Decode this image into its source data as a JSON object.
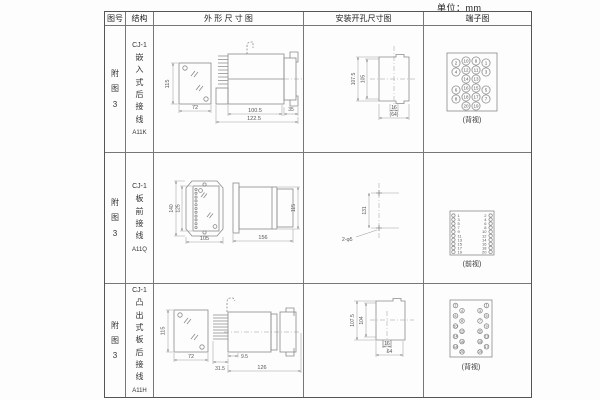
{
  "unit_label": "单位：mm",
  "headers": {
    "fig_no": "图号",
    "structure": "结构",
    "outline": "外 形 尺 寸 图",
    "mounting": "安装开孔尺寸图",
    "terminal": "端子图"
  },
  "rows": [
    {
      "fig_no": "附图3",
      "model": "CJ-1",
      "structure": "嵌入式后接线",
      "code": "A11K",
      "outline": {
        "front_h": "115",
        "front_w": "72",
        "body_len": "100.5",
        "total_len": "122.5",
        "flange": "35"
      },
      "mounting": {
        "outer_h": "107.5",
        "inner_h": "105",
        "slot_w": "16",
        "total_w": "(64)"
      },
      "terminal": {
        "view": "(背视)",
        "grid": [
          [
            "2",
            "10",
            "9",
            "1"
          ],
          [
            "4",
            "12",
            "11",
            "3"
          ],
          [
            "14",
            "13"
          ],
          [
            "6",
            "16",
            "15",
            "5"
          ],
          [
            "8",
            "18",
            "17",
            "7"
          ],
          [
            "20",
            "19"
          ]
        ]
      }
    },
    {
      "fig_no": "附图3",
      "model": "CJ-1",
      "structure": "板前接线",
      "code": "A11Q",
      "outline": {
        "front_h_outer": "140",
        "front_h_inner": "125",
        "front_w": "105",
        "side_len": "156",
        "side_h": "115"
      },
      "mounting": {
        "hole_dist": "131",
        "hole_label": "2-φ5"
      },
      "terminal": {
        "view": "(前视)",
        "pairs": [
          [
            "1",
            "2"
          ],
          [
            "3",
            "4"
          ],
          [
            "5",
            "6"
          ],
          [
            "7",
            "8"
          ],
          [
            "9",
            "10"
          ],
          [
            "11",
            "12"
          ],
          [
            "13",
            "14"
          ],
          [
            "15",
            "16"
          ],
          [
            "17",
            "18"
          ],
          [
            "19",
            "20"
          ]
        ]
      }
    },
    {
      "fig_no": "附图3",
      "model": "CJ-1",
      "structure": "凸出式板后接线",
      "code": "A11H",
      "outline": {
        "front_h": "115",
        "front_w": "72",
        "comb": "31.5",
        "gap": "9.5",
        "total_len": "126"
      },
      "mounting": {
        "outer_h": "107.5",
        "inner_h": "104",
        "slot_w": "16",
        "total_w": "64"
      },
      "terminal": {
        "view": "(背视)",
        "left": [
          "2",
          "4",
          "6",
          "8",
          "10",
          "12",
          "14",
          "16",
          "18",
          "20"
        ],
        "right": [
          "1",
          "3",
          "5",
          "7",
          "9",
          "11",
          "13",
          "15",
          "17",
          "19"
        ]
      }
    }
  ]
}
